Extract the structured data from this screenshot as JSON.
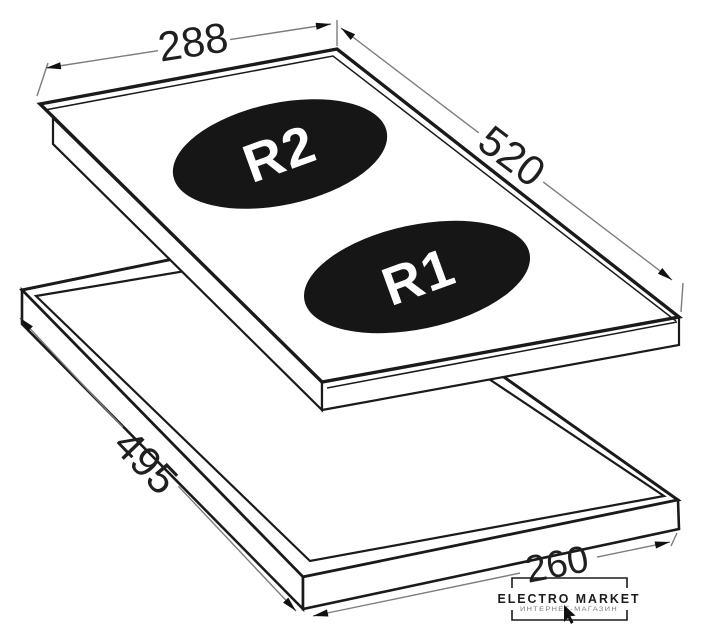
{
  "figure": {
    "type": "technical-drawing",
    "subject": "two-zone domino hob with worktop cutout",
    "dimensions": {
      "top_width": "288",
      "top_length": "520",
      "cutout_length": "495",
      "cutout_width": "260"
    },
    "burners": {
      "rear_label": "R2",
      "front_label": "R1"
    },
    "colors": {
      "line": "#1a1a1a",
      "dim_line": "#7d7d7d",
      "burner_fill": "#161616",
      "burner_text": "#ffffff",
      "background": "#ffffff"
    }
  },
  "logo": {
    "title": "ELECTRO MARKET",
    "subtitle": "ИНТЕРНЕТ-МАГАЗИН"
  }
}
